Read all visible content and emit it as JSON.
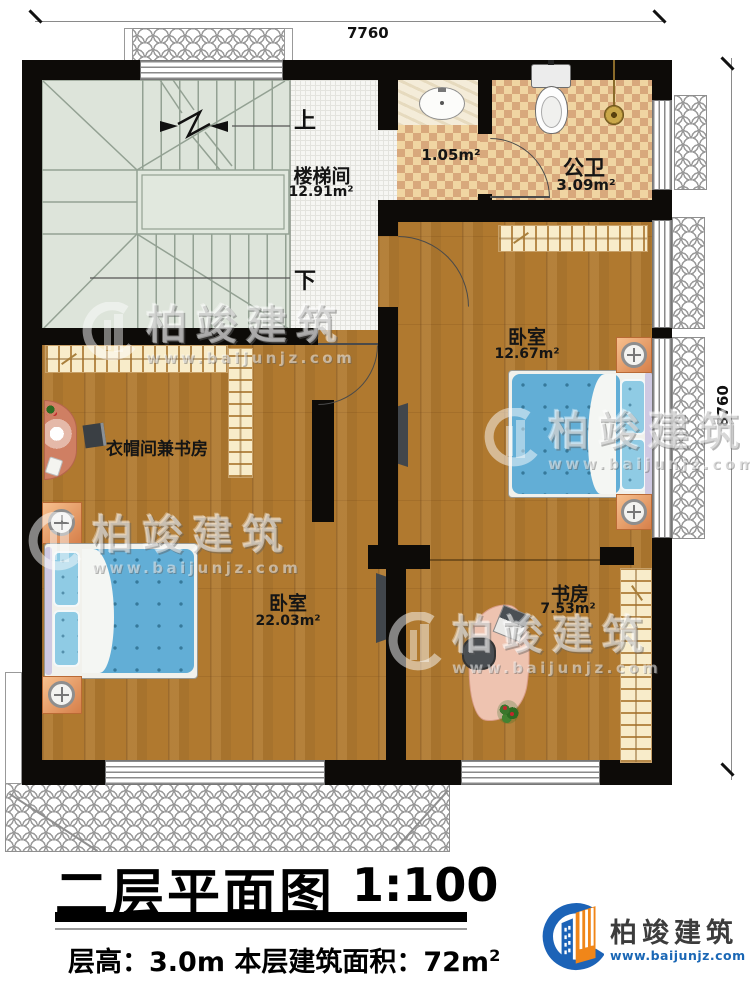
{
  "dims": {
    "top": "7760",
    "right": "8760"
  },
  "stairwell": {
    "name": "楼梯间",
    "area": "12.91m²",
    "up": "上",
    "down": "下"
  },
  "bathroom": {
    "name": "公卫",
    "area": "3.09m²",
    "vestibule_area": "1.05m²"
  },
  "bedroom_right": {
    "name": "卧室",
    "area": "12.67m²"
  },
  "cloakroom": {
    "name": "衣帽间兼书房"
  },
  "bedroom_left": {
    "name": "卧室",
    "area": "22.03m²"
  },
  "study": {
    "name": "书房",
    "area": "7.53m²"
  },
  "title": {
    "main": "二层平面图",
    "scale": "1:100"
  },
  "footer": {
    "info": "层高：3.0m  本层建筑面积：72m",
    "area_sup": "2"
  },
  "brand": {
    "name": "柏竣建筑",
    "url": "www.baijunjz.com"
  },
  "watermark": {
    "name": "柏竣建筑",
    "url": "www.baijunjz.com"
  },
  "colors": {
    "wall": "#0d0b08",
    "wood_floor": "#b0792f",
    "tile_dark": "#d8a87c",
    "tile_light": "#f0d5a2",
    "stair_floor": "#dde4da",
    "bed_blue": "#62aed6",
    "nightstand_orange": "#e09a63",
    "roof_line": "#9a9a9a",
    "brand_blue": "#1c63b7",
    "brand_orange": "#f08619"
  }
}
